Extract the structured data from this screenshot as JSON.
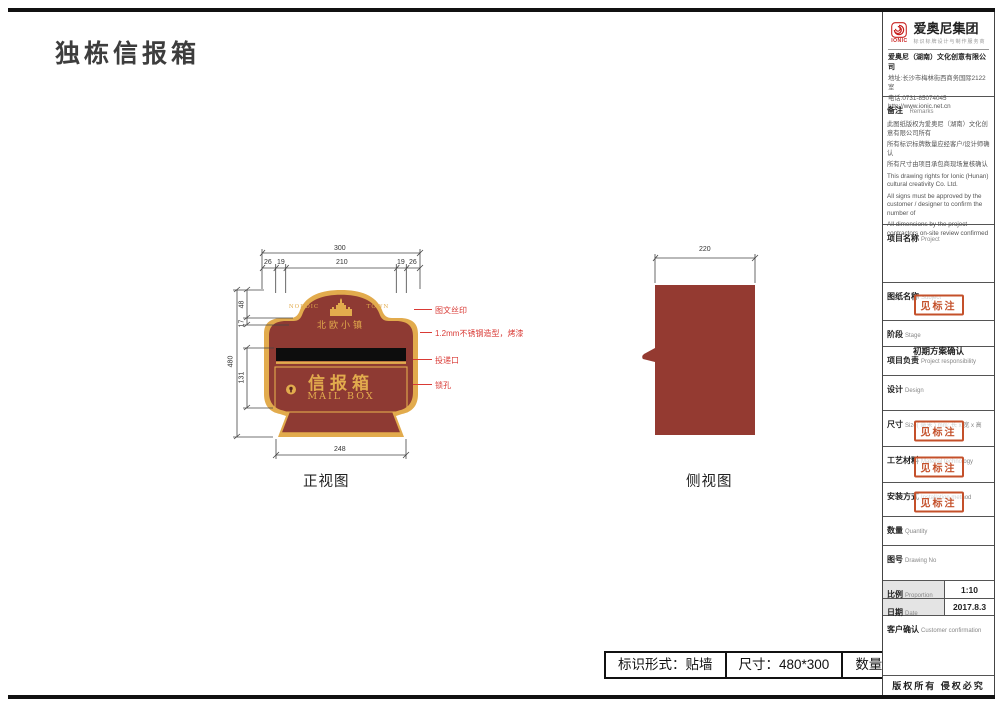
{
  "sheet": {
    "title": "独栋信报箱",
    "copyright": "版权所有 侵权必究",
    "stamp_text": "见标注"
  },
  "company": {
    "logo_text": "IONIC",
    "group_name": "爱奥尼集团",
    "tagline": "标识标牌设计与制作服务商",
    "full_name": "爱奥尼（湖南）文化创意有限公司",
    "address": "地址:长沙市梅林街西商务国际2122室",
    "phone": "电话:0731-85074045",
    "website": "http://www.ionic.net.cn"
  },
  "remarks": {
    "label_zh": "备注",
    "label_en": "Remarks",
    "items_zh": [
      "此图纸版权为爱奥尼（湖南）文化创意有限公司所有",
      "所有标识标牌数量应经客户/设计师确认",
      "所有尺寸由项目承包商现场复核确认"
    ],
    "items_en": [
      "This drawing rights for Ionic (Hunan) cultural creativity Co. Ltd.",
      "All signs must be approved by the customer / designer to confirm the number of",
      "All dimensions by the project contractors on-site review confirmed"
    ]
  },
  "fields": [
    {
      "zh": "项目名称",
      "en": "Project",
      "value": ""
    },
    {
      "zh": "图纸名称",
      "en": "Subject",
      "value": "见标注"
    },
    {
      "zh": "阶段",
      "en": "Stage",
      "value": "初期方案确认"
    },
    {
      "zh": "项目负责",
      "en": "Project responsibility",
      "value": ""
    },
    {
      "zh": "设计",
      "en": "Design",
      "value": ""
    },
    {
      "zh": "尺寸",
      "en": "Size( 毫米 ) mm; 长 x 宽 x 高",
      "value": "见标注"
    },
    {
      "zh": "工艺材料",
      "en": "Material technology",
      "value": "见标注"
    },
    {
      "zh": "安装方式",
      "en": "Installation method",
      "value": "见标注"
    },
    {
      "zh": "数量",
      "en": "Quantity",
      "value": ""
    },
    {
      "zh": "图号",
      "en": "Drawing No",
      "value": ""
    }
  ],
  "meta_rows": [
    {
      "zh": "比例",
      "en": "Proportion",
      "value": "1:10"
    },
    {
      "zh": "日期",
      "en": "Date",
      "value": "2017.8.3"
    }
  ],
  "customer": {
    "zh": "客户确认",
    "en": "Customer confirmation"
  },
  "drawing": {
    "front_label": "正视图",
    "side_label": "侧视图",
    "mailbox": {
      "estate_en_left": "NORDIC",
      "estate_en_right": "TOWN",
      "estate_zh": "北欧小镇",
      "title_zh": "信报箱",
      "title_en": "MAIL BOX"
    },
    "dims": {
      "width_total": "300",
      "w1": "26",
      "w2": "19",
      "w3": "210",
      "w4": "19",
      "w5": "26",
      "height_total": "480",
      "h1": "48",
      "h2": "17",
      "h3": "131",
      "base_width": "248",
      "side_depth": "220"
    },
    "annotations": [
      "图文丝印",
      "1.2mm不锈钢造型，烤漆",
      "投递口",
      "锁孔"
    ]
  },
  "spec_bar": {
    "form": "标识形式：贴墙",
    "size": "尺寸：480*300",
    "qty": "数量：95块"
  },
  "colors": {
    "maroon": "#8e3a33",
    "gold": "#e2ab4d",
    "annotation_red": "#d93a35",
    "stamp_red": "#c4502a",
    "logo_red": "#c8201e"
  }
}
